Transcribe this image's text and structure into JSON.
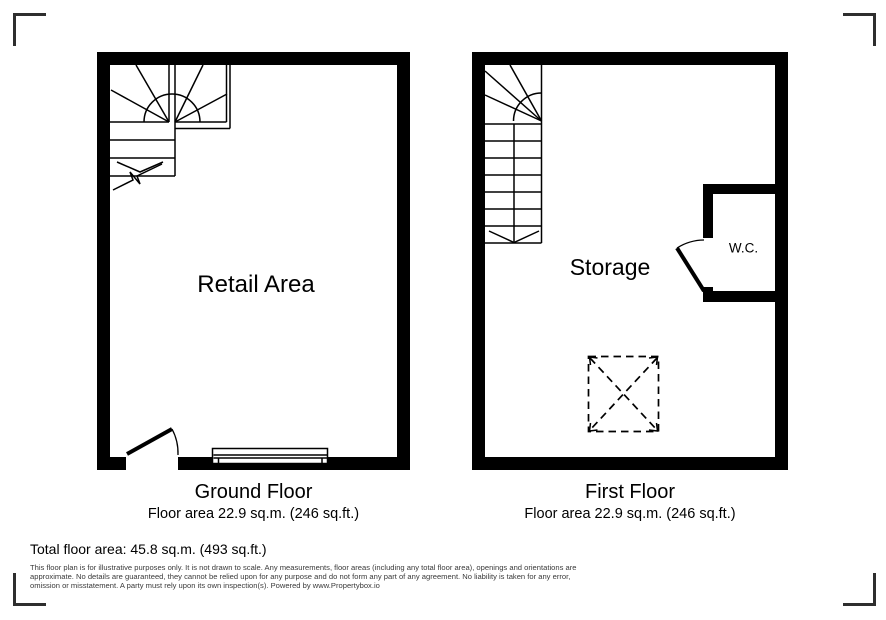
{
  "colors": {
    "plan_lines": "#000000",
    "corner_marks": "#2e2e2e",
    "disclaimer_text": "#3a3a3a",
    "background": "#ffffff"
  },
  "plans": {
    "ground": {
      "room_label": "Retail Area",
      "title": "Ground Floor",
      "area_text": "Floor area 22.9 sq.m. (246 sq.ft.)"
    },
    "first": {
      "room_label": "Storage",
      "wc_label": "W.C.",
      "title": "First Floor",
      "area_text": "Floor area 22.9 sq.m. (246 sq.ft.)"
    }
  },
  "summary": {
    "total_area": "Total floor area: 45.8 sq.m. (493 sq.ft.)"
  },
  "disclaimer": {
    "lines": [
      "This floor plan is for illustrative purposes only. It is not drawn to scale. Any measurements, floor areas (including any total floor area), openings and orientations are",
      "approximate. No details are guaranteed, they cannot be relied upon for any purpose and do not form any part of any agreement. No liability is taken for any error,",
      "omission or misstatement. A party must rely upon its own inspection(s). Powered by www.Propertybox.io"
    ]
  }
}
